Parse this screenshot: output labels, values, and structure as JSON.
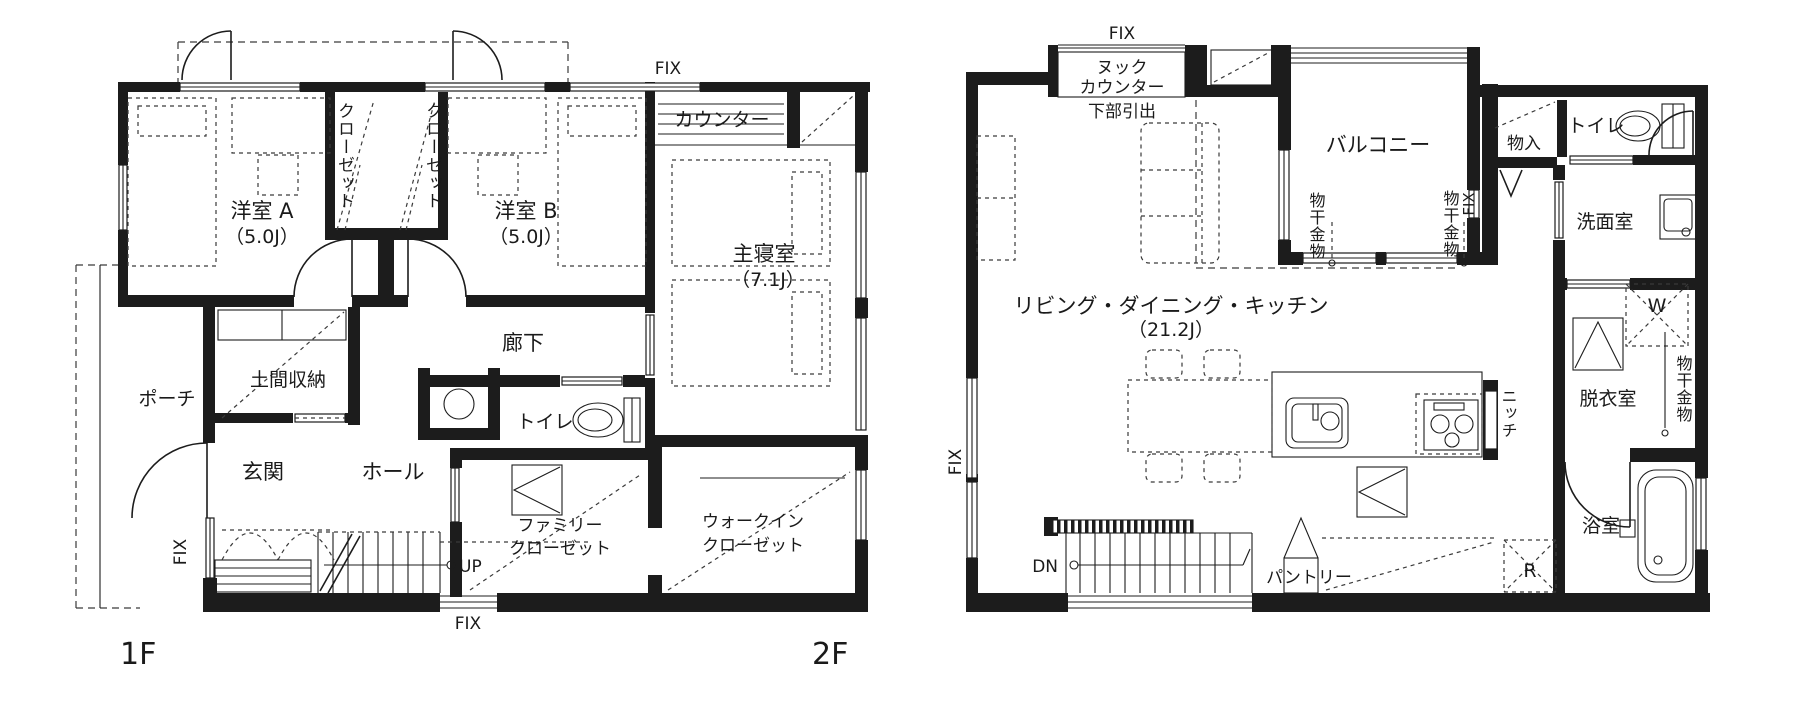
{
  "page": {
    "background": "#ffffff",
    "ink": "#1c1c1c"
  },
  "floor1": {
    "name": "1F",
    "labels": {
      "fix": "FIX",
      "counter": "カウンター",
      "closet": "クローゼット",
      "room_a_name": "洋室 A",
      "room_a_size": "（5.0J）",
      "room_b_name": "洋室 B",
      "room_b_size": "（5.0J）",
      "master_name": "主寝室",
      "master_size": "（7.1J）",
      "corridor": "廊下",
      "toilet": "トイレ",
      "doma": "土間収納",
      "porch": "ポーチ",
      "entrance": "玄関",
      "hall": "ホール",
      "up": "UP",
      "family_closet_1": "ファミリー",
      "family_closet_2": "クローゼット",
      "wic_1": "ウォークイン",
      "wic_2": "クローゼット"
    }
  },
  "floor2": {
    "name": "2F",
    "labels": {
      "fix": "FIX",
      "nook_1": "ヌック",
      "nook_2": "カウンター",
      "drawer": "下部引出",
      "balcony": "バルコニー",
      "laundry": "物干金物",
      "storage": "物入",
      "toilet": "トイレ",
      "washroom": "洗面室",
      "washer": "W",
      "ldk_name": "リビング・ダイニング・キッチン",
      "ldk_size": "（21.2J）",
      "niche": "ニッチ",
      "dressing": "脱衣室",
      "down": "DN",
      "pantry": "パントリー",
      "fridge": "R",
      "bath": "浴室"
    }
  }
}
